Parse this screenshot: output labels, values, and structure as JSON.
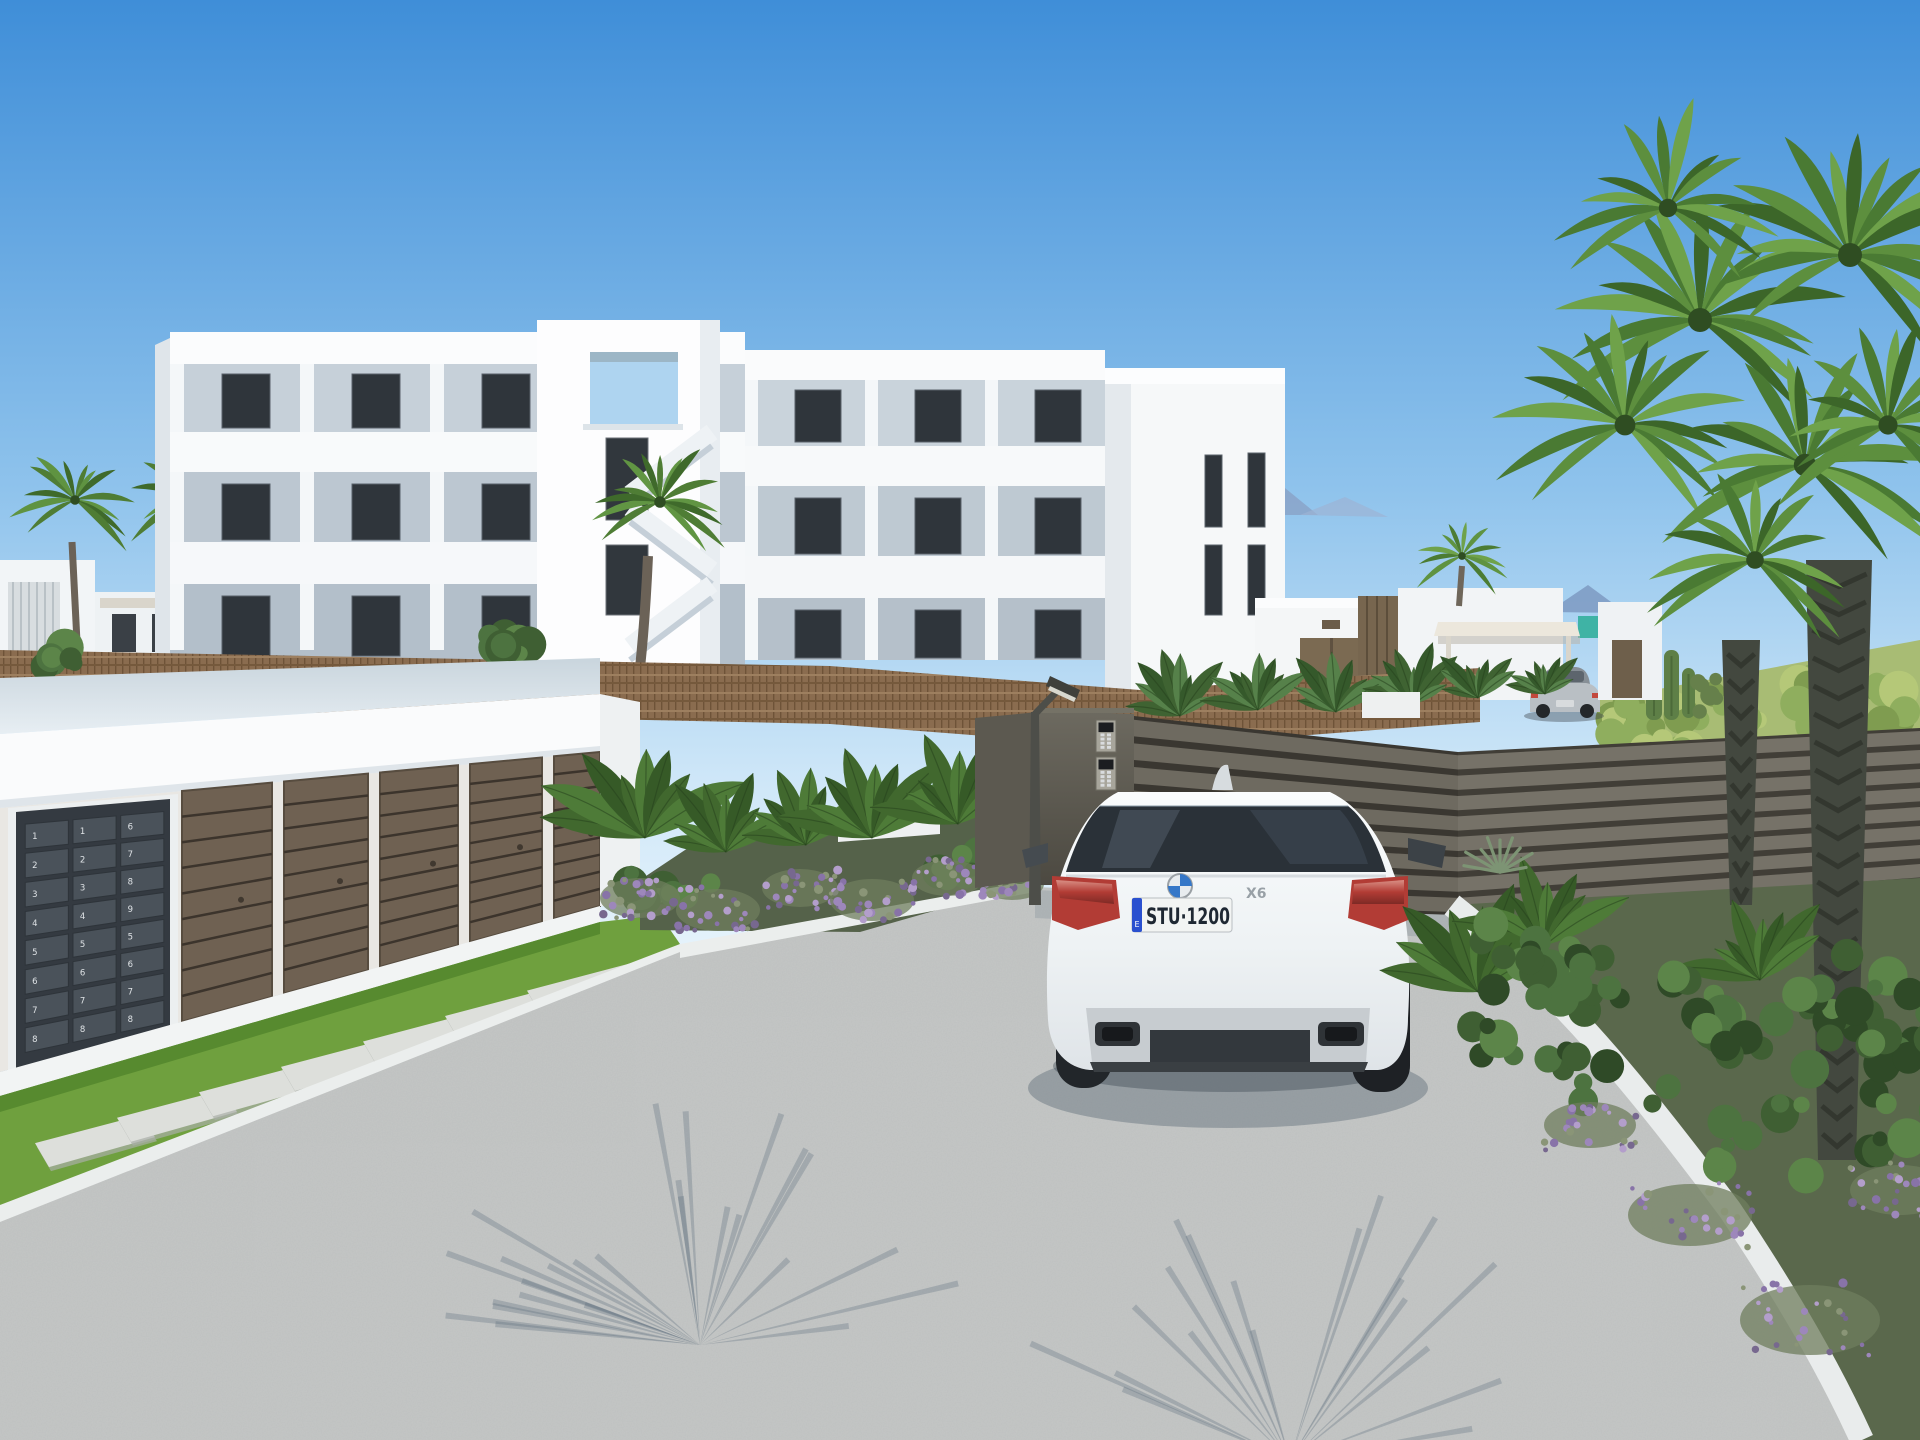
{
  "scene": {
    "type": "3d-architectural-render",
    "description": "New-build white Mediterranean apartment complex behind a gated driveway entrance: garage block with numbered mailboxes on the left, a white BMW X6 waiting at the grey slatted entrance gate, a silver sports coupe parked inside, palm trees, banana plants and lavender landscaping under a clear blue sky",
    "time_of_day": "day",
    "sky": "clear"
  },
  "colors": {
    "sky_top": "#3f8ed8",
    "sky_horizon": "#e9f5fc",
    "building_white": "#fafbfc",
    "balcony_recess": "#c6d0d9",
    "window_dark": "#2f353b",
    "wattle_fence": "#8a6c4f",
    "gate_grey": "#6e6a60",
    "garage_door_brown": "#6f6152",
    "mailbox_charcoal": "#3f464e",
    "driveway_grey": "#c5c7c6",
    "kerb_white": "#ebeeed",
    "grass_green": "#6fa03e",
    "palm_green": "#578f39",
    "mountain_blue": "#8aa3c8",
    "skyline_blue": "#6f94d6",
    "car_white": "#f4f6f8",
    "tail_light_red": "#b23c35",
    "eu_band_blue": "#2a50cf",
    "teal_accent": "#3fb3a5",
    "silver_car": "#b9bfc4"
  },
  "car": {
    "brand": "BMW",
    "model_badge": "X6",
    "license_plate": "STU·1200",
    "plate_country_letter": "E",
    "color": "white"
  },
  "background_car": {
    "type": "sports-coupe",
    "color": "silver"
  },
  "mailboxes": {
    "columns": [
      {
        "numbers": [
          "1",
          "2",
          "3",
          "4",
          "5",
          "6",
          "7",
          "8"
        ]
      },
      {
        "numbers": [
          "1",
          "2",
          "3",
          "4",
          "5",
          "6",
          "7",
          "8"
        ]
      },
      {
        "numbers": [
          "6",
          "7",
          "8",
          "9",
          "5",
          "6",
          "7",
          "8"
        ]
      }
    ]
  },
  "gate": {
    "intercom_panels": 2,
    "material": "horizontal metal slats"
  },
  "building": {
    "floors": 3,
    "balconies": true,
    "stair_tower": true
  },
  "vegetation": {
    "palm_trees": 6,
    "banana_plants": true,
    "lavender": true,
    "cacti": true
  }
}
